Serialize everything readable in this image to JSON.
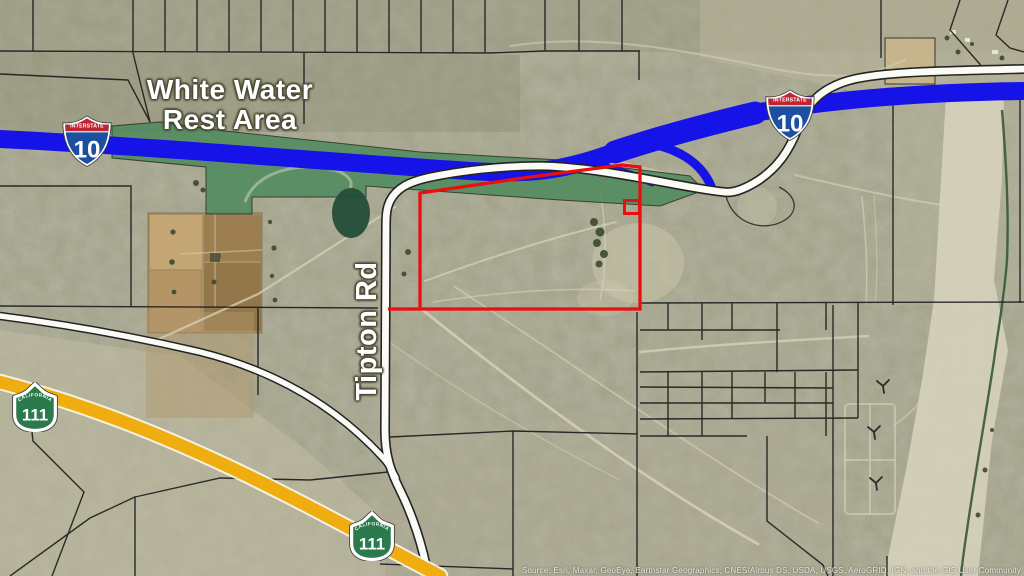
{
  "map": {
    "rest_area_label": {
      "line1": "White Water",
      "line2": "Rest Area"
    },
    "road_label": "Tipton Rd",
    "shields": {
      "interstate_10": {
        "header": "INTERSTATE",
        "number": "10"
      },
      "ca_111": {
        "header": "CALIFORNIA",
        "number": "111"
      }
    },
    "attribution": "Source: Esri, Maxar, GeoEye, Earthstar Geographics, CNES/Airbus DS, USDA, USGS, AeroGRID, IGN, and the GIS User Community",
    "colors": {
      "interstate_highway_blue": "#1513e8",
      "state_highway_yellow": "#f0ad10",
      "parcel_outline_red": "#e90f0f",
      "rest_area_green": "#4f8a5d",
      "shield_interstate_red": "#bf2431",
      "shield_interstate_blue": "#1d4fa1",
      "shield_state_green": "#2a7a4c"
    }
  }
}
